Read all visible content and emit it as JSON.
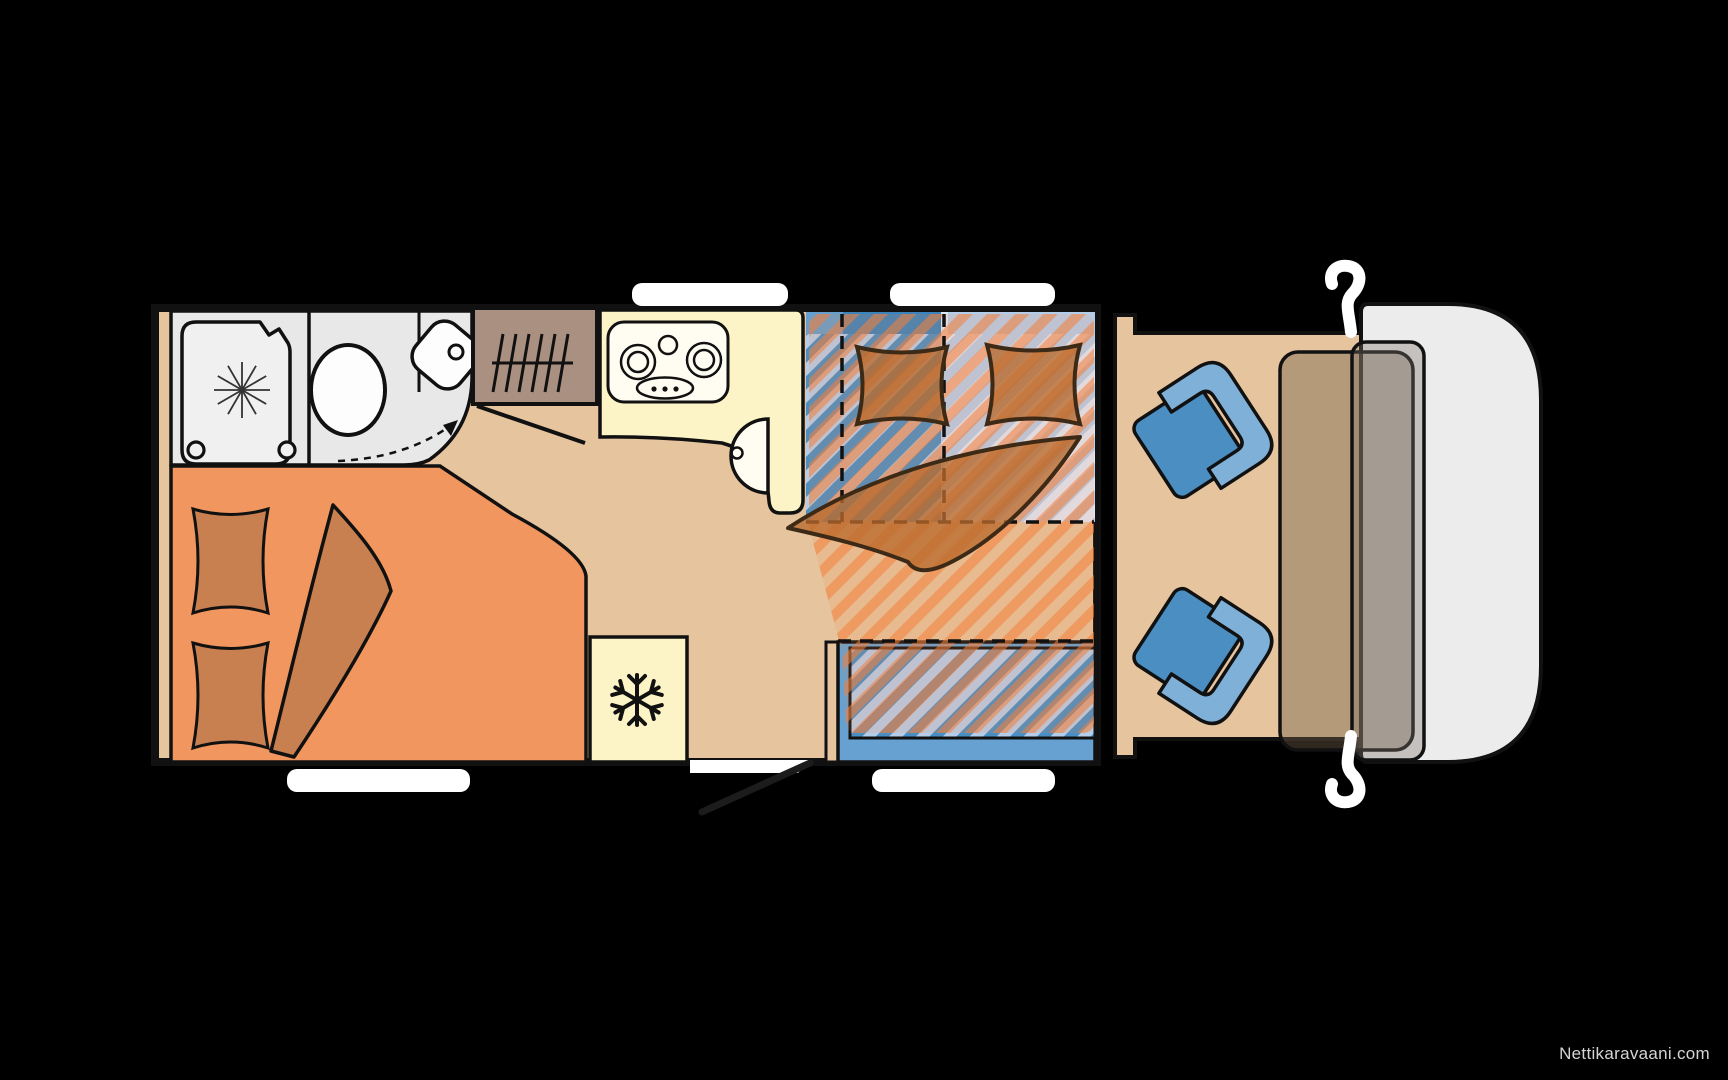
{
  "watermark": {
    "text": "Nettikaravaani.com"
  },
  "diagram": {
    "type": "motorhome-floorplan-top-view",
    "background": "#000000",
    "colors": {
      "floor": "#e5c49e",
      "bathroom": "#e8e8e8",
      "shower_tray": "#f0f0f0",
      "fixture_white": "#fdfdfd",
      "wardrobe": "#aa9080",
      "kitchen": "#fcf3c6",
      "worktop_white": "#fffdf2",
      "bed_orange": "#f0965e",
      "bedding_orange": "#c98051",
      "bedding_outline": "#3d2a16",
      "uph_blue": "#4a8fc4",
      "uph_light": "#b6cdea",
      "uph_pale": "#dfe8f7",
      "headrest_medium": "#669fcd",
      "headrest_dark": "#3c83bb",
      "bench_blue": "#66a1d1",
      "overlay_strong": "rgba(243,128,58,0.62)",
      "overlay_weak": "rgba(243,128,58,0.14)",
      "overlay_bedding": "rgba(186,106,45,0.78)",
      "seat_base": "#4a8ec2",
      "seat_back": "#7fb0d8",
      "cab_body": "#ececec",
      "dashboard": "rgba(115,95,75,0.42)",
      "windshield": "rgba(125,115,105,0.35)",
      "window_white": "#ffffff",
      "watermark": "#d4d4d4"
    },
    "features": [
      {
        "name": "shower-icon",
        "glyph": "asterisk-drain"
      },
      {
        "name": "toilet-icon",
        "glyph": "oval-bowl"
      },
      {
        "name": "washbasin-icon",
        "glyph": "rounded-corner-basin"
      },
      {
        "name": "wardrobe-icon",
        "glyph": "hanger-rail"
      },
      {
        "name": "stove-icon",
        "glyph": "three-burner-hob"
      },
      {
        "name": "kitchen-sink-icon",
        "glyph": "half-round-basin"
      },
      {
        "name": "refrigerator-icon",
        "glyph": "snowflake"
      },
      {
        "name": "rear-double-bed",
        "glyph": "pillows-and-duvet"
      },
      {
        "name": "dinette-seating",
        "glyph": "striped-upholstery"
      },
      {
        "name": "drop-down-bed",
        "glyph": "orange-hatch-overlay"
      },
      {
        "name": "entry-door",
        "glyph": "open-door-swing"
      },
      {
        "name": "cab-swivel-seats",
        "glyph": "two-captain-chairs"
      },
      {
        "name": "dashboard",
        "glyph": "translucent-console"
      },
      {
        "name": "side-mirrors",
        "glyph": "white-hooks"
      },
      {
        "name": "windows",
        "glyph": "white-rounded-bars"
      }
    ]
  }
}
